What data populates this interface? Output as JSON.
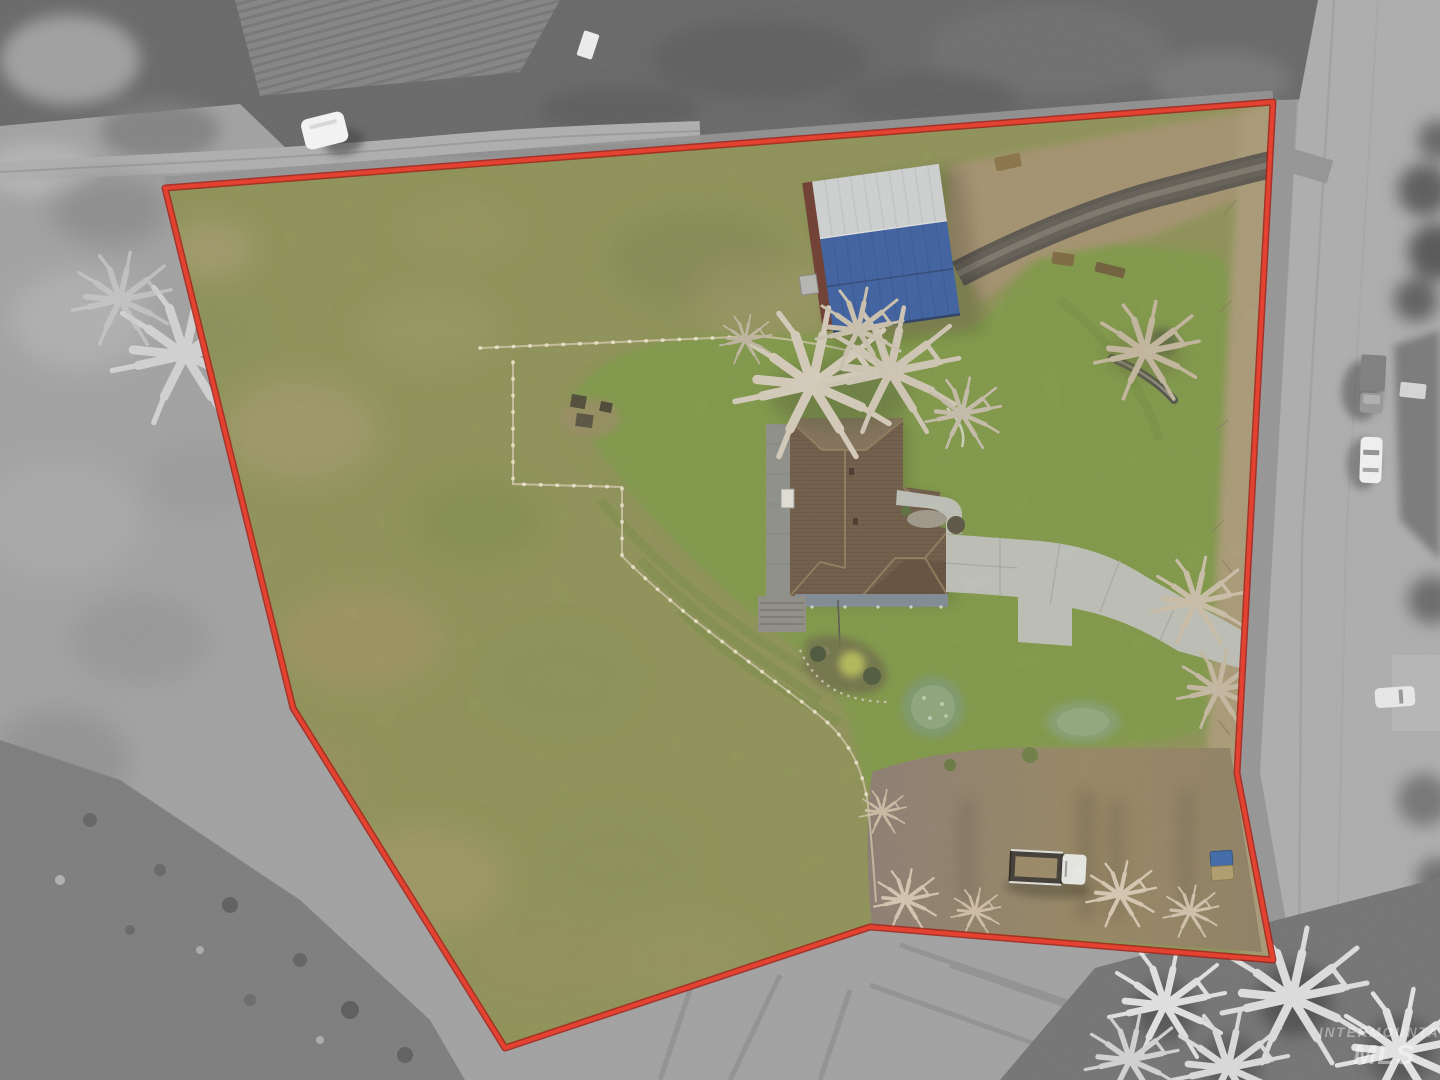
{
  "watermark": {
    "line1": "INTERMOUNTAIN",
    "line2": "MLS"
  },
  "colors": {
    "boundary_red": "#e23726",
    "boundary_red_dark": "#9c1710",
    "pasture_green": "#8e9357",
    "lawn_green": "#7f9a46",
    "house_roof_brown": "#6f5a47",
    "house_side_gray": "#8e908c",
    "porch_bluegray": "#7f8b96",
    "barn_roof_blue": "#3c5fa5",
    "barn_roof_silver": "#d3d7da",
    "barn_wall_red": "#6e3b2f",
    "concrete_gray": "#c0c3bd",
    "gravel_dark": "#615d55",
    "dirt_mauve": "#8d7d74",
    "dirt_tan": "#a5936f",
    "brush_tan": "#ab9c78",
    "road_gray": "#a7a7a7",
    "surround_gray": "#9b9b9b"
  }
}
